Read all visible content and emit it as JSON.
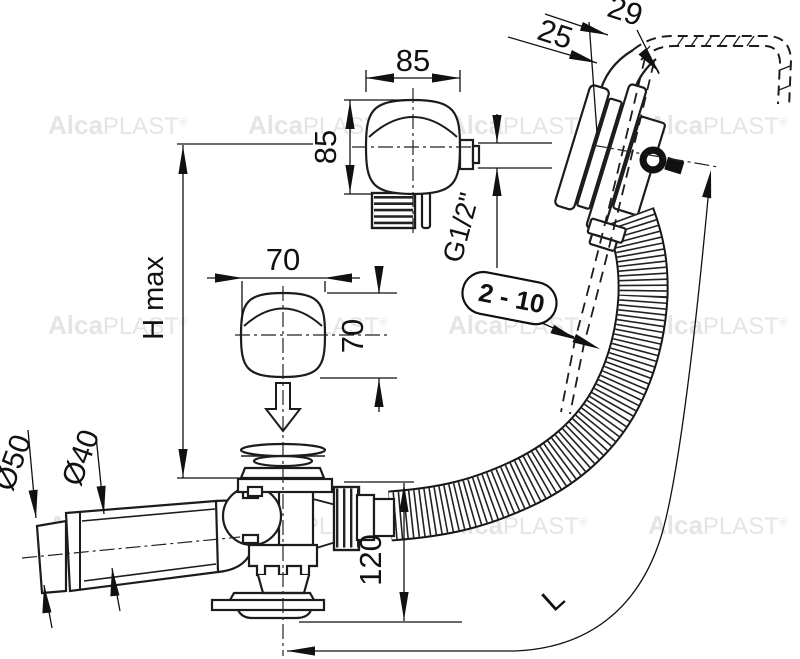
{
  "watermark": {
    "brand_bold": "Alca",
    "brand_light": "PLAST",
    "registered": "®"
  },
  "labels": {
    "h_max": "H max",
    "knob_large_width": "85",
    "knob_large_height": "85",
    "knob_small_width": "70",
    "knob_small_height": "70",
    "overflow_offset_outer": "29",
    "overflow_offset_inner": "25",
    "thread_size": "G1/2\"",
    "panel_thickness_range": "2 - 10",
    "drain_height": "120",
    "hose_length": "L",
    "outlet_socket_diameter": "Ø50",
    "outlet_pipe_diameter": "Ø40"
  }
}
